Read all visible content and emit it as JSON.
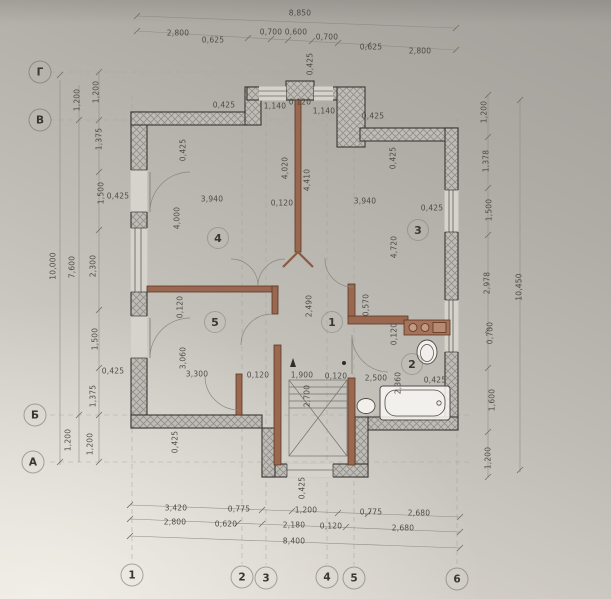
{
  "colors": {
    "paper_light": "#ddd9d1",
    "paper_dark": "#a39f9a",
    "wall_fill": "#bfbcb7",
    "wall_hatch": "#908e88",
    "wall_outline": "#3a3834",
    "partition_brown": "#9a6850",
    "partition_edge": "#5c3724",
    "grid_line": "#a3a099",
    "dimension_line": "#8f8c85",
    "text": "#45433e"
  },
  "dimensions": [
    {
      "t": "8,850",
      "x": 300,
      "y": 13
    },
    {
      "t": "2,800",
      "x": 178,
      "y": 33
    },
    {
      "t": "0,625",
      "x": 213,
      "y": 40
    },
    {
      "t": "0,700",
      "x": 271,
      "y": 32
    },
    {
      "t": "0,600",
      "x": 296,
      "y": 32
    },
    {
      "t": "0,700",
      "x": 327,
      "y": 37
    },
    {
      "t": "0,625",
      "x": 371,
      "y": 47
    },
    {
      "t": "2,800",
      "x": 420,
      "y": 51
    },
    {
      "t": "0,425",
      "x": 310,
      "y": 64,
      "r": -90
    },
    {
      "t": "0,120",
      "x": 300,
      "y": 102
    },
    {
      "t": "1,140",
      "x": 275,
      "y": 106
    },
    {
      "t": "1,140",
      "x": 324,
      "y": 111
    },
    {
      "t": "0,425",
      "x": 224,
      "y": 105
    },
    {
      "t": "0,425",
      "x": 373,
      "y": 116
    },
    {
      "t": "0,425",
      "x": 183,
      "y": 150,
      "r": -90
    },
    {
      "t": "0,425",
      "x": 393,
      "y": 158,
      "r": -90
    },
    {
      "t": "4,020",
      "x": 285,
      "y": 168,
      "r": -90
    },
    {
      "t": "4,410",
      "x": 307,
      "y": 180,
      "r": -90
    },
    {
      "t": "3,940",
      "x": 212,
      "y": 199
    },
    {
      "t": "0,120",
      "x": 282,
      "y": 203
    },
    {
      "t": "3,940",
      "x": 365,
      "y": 201
    },
    {
      "t": "0,425",
      "x": 432,
      "y": 208
    },
    {
      "t": "4,000",
      "x": 177,
      "y": 218,
      "r": -90
    },
    {
      "t": "4,720",
      "x": 394,
      "y": 247,
      "r": -90
    },
    {
      "t": "0,425",
      "x": 118,
      "y": 196
    },
    {
      "t": "2,490",
      "x": 309,
      "y": 306,
      "r": -90
    },
    {
      "t": "0,570",
      "x": 366,
      "y": 305,
      "r": -90
    },
    {
      "t": "0,120",
      "x": 180,
      "y": 307,
      "r": -90
    },
    {
      "t": "0,120",
      "x": 394,
      "y": 334,
      "r": -90
    },
    {
      "t": "3,060",
      "x": 183,
      "y": 358,
      "r": -90
    },
    {
      "t": "2,360",
      "x": 398,
      "y": 383,
      "r": -90
    },
    {
      "t": "0,425",
      "x": 435,
      "y": 380
    },
    {
      "t": "2,500",
      "x": 376,
      "y": 378
    },
    {
      "t": "3,300",
      "x": 197,
      "y": 374
    },
    {
      "t": "0,120",
      "x": 258,
      "y": 375
    },
    {
      "t": "1,900",
      "x": 302,
      "y": 375
    },
    {
      "t": "0,120",
      "x": 336,
      "y": 376
    },
    {
      "t": "2,700",
      "x": 307,
      "y": 396,
      "r": -90
    },
    {
      "t": "0,425",
      "x": 175,
      "y": 442,
      "r": -90
    },
    {
      "t": "0,425",
      "x": 113,
      "y": 371
    },
    {
      "t": "0,425",
      "x": 302,
      "y": 488,
      "r": -90
    },
    {
      "t": "1,200",
      "x": 77,
      "y": 100,
      "r": -90
    },
    {
      "t": "1,200",
      "x": 96,
      "y": 92,
      "r": -90
    },
    {
      "t": "1,375",
      "x": 99,
      "y": 139,
      "r": -90
    },
    {
      "t": "1,500",
      "x": 101,
      "y": 193,
      "r": -90
    },
    {
      "t": "10,000",
      "x": 53,
      "y": 266,
      "r": -90
    },
    {
      "t": "7,600",
      "x": 72,
      "y": 267,
      "r": -90
    },
    {
      "t": "2,300",
      "x": 93,
      "y": 266,
      "r": -90
    },
    {
      "t": "1,500",
      "x": 95,
      "y": 339,
      "r": -90
    },
    {
      "t": "1,375",
      "x": 93,
      "y": 396,
      "r": -90
    },
    {
      "t": "1,200",
      "x": 68,
      "y": 440,
      "r": -90
    },
    {
      "t": "1,200",
      "x": 90,
      "y": 444,
      "r": -90
    },
    {
      "t": "1,200",
      "x": 484,
      "y": 112,
      "r": -90
    },
    {
      "t": "1,378",
      "x": 486,
      "y": 161,
      "r": -90
    },
    {
      "t": "1,500",
      "x": 489,
      "y": 210,
      "r": -90
    },
    {
      "t": "2,978",
      "x": 487,
      "y": 283,
      "r": -90
    },
    {
      "t": "0,700",
      "x": 490,
      "y": 333,
      "r": -90
    },
    {
      "t": "1,600",
      "x": 492,
      "y": 400,
      "r": -90
    },
    {
      "t": "1,200",
      "x": 488,
      "y": 458,
      "r": -90
    },
    {
      "t": "10,450",
      "x": 519,
      "y": 287,
      "r": -90
    },
    {
      "t": "3,420",
      "x": 176,
      "y": 508
    },
    {
      "t": "0,775",
      "x": 239,
      "y": 509
    },
    {
      "t": "1,200",
      "x": 306,
      "y": 510
    },
    {
      "t": "0,775",
      "x": 371,
      "y": 512
    },
    {
      "t": "2,680",
      "x": 419,
      "y": 513
    },
    {
      "t": "2,800",
      "x": 175,
      "y": 522
    },
    {
      "t": "0,620",
      "x": 226,
      "y": 524
    },
    {
      "t": "2,180",
      "x": 294,
      "y": 525
    },
    {
      "t": "0,120",
      "x": 331,
      "y": 526
    },
    {
      "t": "2,680",
      "x": 403,
      "y": 528
    },
    {
      "t": "8,400",
      "x": 294,
      "y": 541
    }
  ],
  "axis_bubbles": [
    {
      "t": "Г",
      "x": 40,
      "y": 72
    },
    {
      "t": "В",
      "x": 40,
      "y": 120
    },
    {
      "t": "Б",
      "x": 35,
      "y": 415
    },
    {
      "t": "А",
      "x": 33,
      "y": 462
    },
    {
      "t": "1",
      "x": 132,
      "y": 575
    },
    {
      "t": "2",
      "x": 242,
      "y": 577
    },
    {
      "t": "3",
      "x": 266,
      "y": 578
    },
    {
      "t": "4",
      "x": 327,
      "y": 577
    },
    {
      "t": "5",
      "x": 354,
      "y": 578
    },
    {
      "t": "6",
      "x": 457,
      "y": 579
    }
  ],
  "room_labels": [
    {
      "t": "4",
      "x": 218,
      "y": 238
    },
    {
      "t": "3",
      "x": 418,
      "y": 230
    },
    {
      "t": "5",
      "x": 215,
      "y": 322
    },
    {
      "t": "1",
      "x": 332,
      "y": 322
    },
    {
      "t": "2",
      "x": 412,
      "y": 364
    }
  ]
}
